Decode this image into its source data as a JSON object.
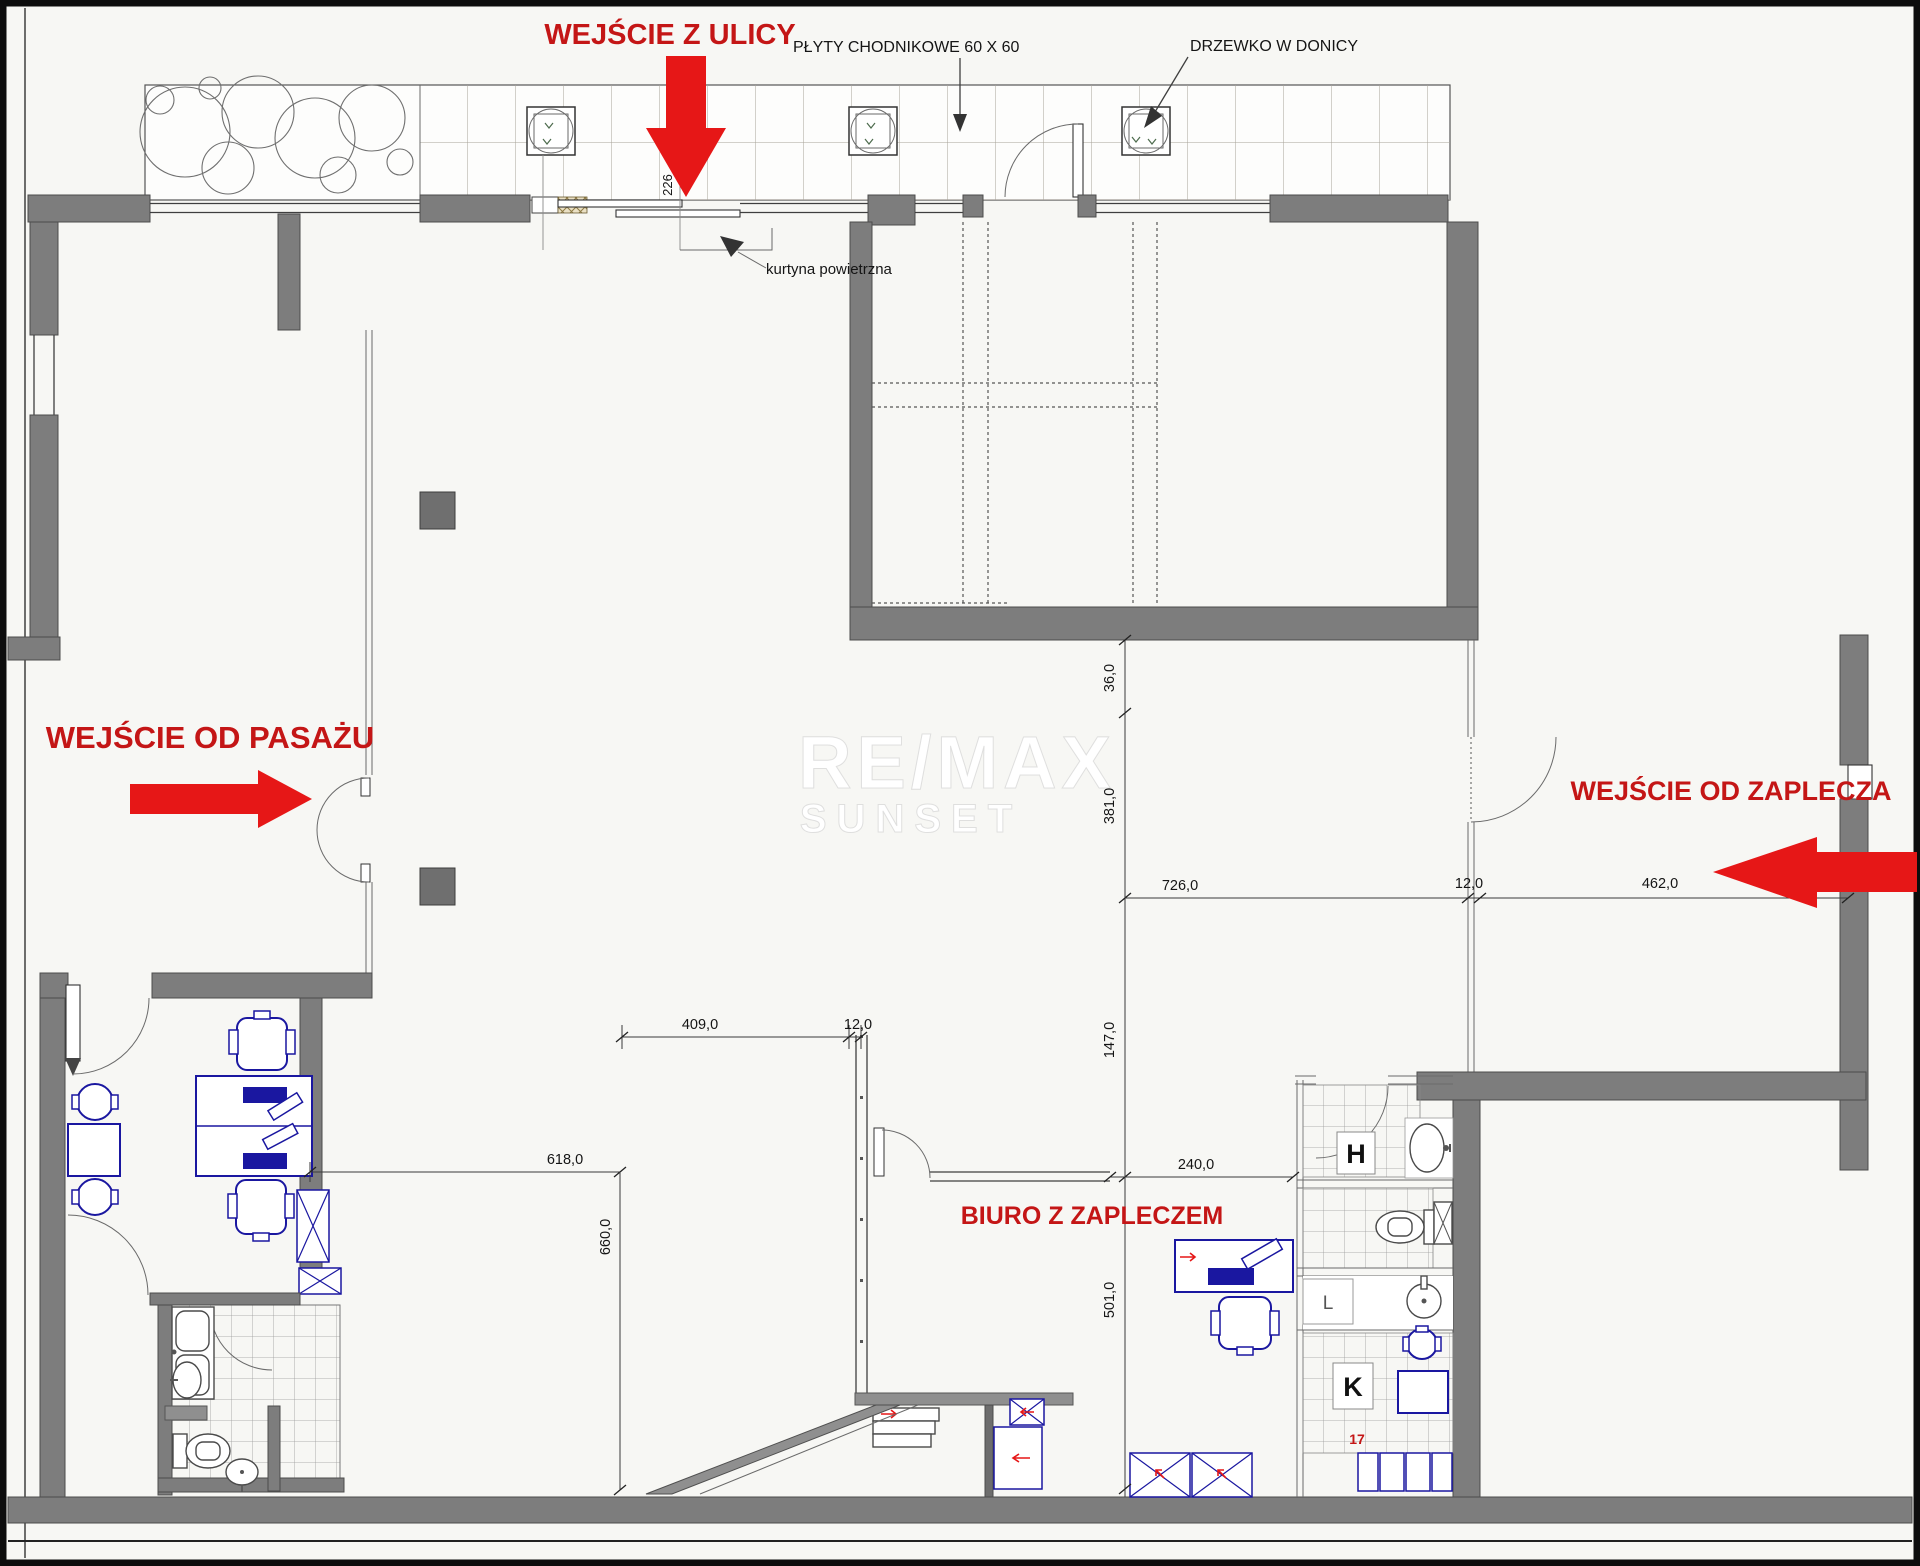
{
  "colors": {
    "label_red": "#c41616",
    "arrow_red": "#e61717",
    "wall": "#7d7d7d",
    "wall_dark": "#4c4c4c",
    "blue": "#1a17a0",
    "line": "#3f3f3f",
    "tile": "#a8a299",
    "bg": "#f7f7f4"
  },
  "labels": {
    "entrance_street": "WEJŚCIE Z ULICY",
    "entrance_passage": "WEJŚCIE OD PASAŻU",
    "entrance_back": "WEJŚCIE OD ZAPLECZA",
    "office": "BIURO Z ZAPLECZEM",
    "sidewalk_note": "PŁYTY CHODNIKOWE 60 X 60",
    "tree_note": "DRZEWKO W DONICY",
    "air_curtain": "kurtyna powietrzna"
  },
  "rooms": {
    "h": "H",
    "l": "L",
    "k": "K",
    "unit17": "17"
  },
  "dimensions": {
    "door_width": "226",
    "wall_gap": "36,0",
    "hall_depth": "381,0",
    "hall_width": "726,0",
    "wall_a": "12,0",
    "corridor_width": "462,0",
    "mid_depth": "147,0",
    "show_width": "409,0",
    "wall_b": "12,0",
    "show_left": "618,0",
    "show_depth": "660,0",
    "office_width": "240,0",
    "office_depth": "501,0"
  },
  "watermark": {
    "line1": "RE/MAX",
    "line2": "SUNSET"
  }
}
